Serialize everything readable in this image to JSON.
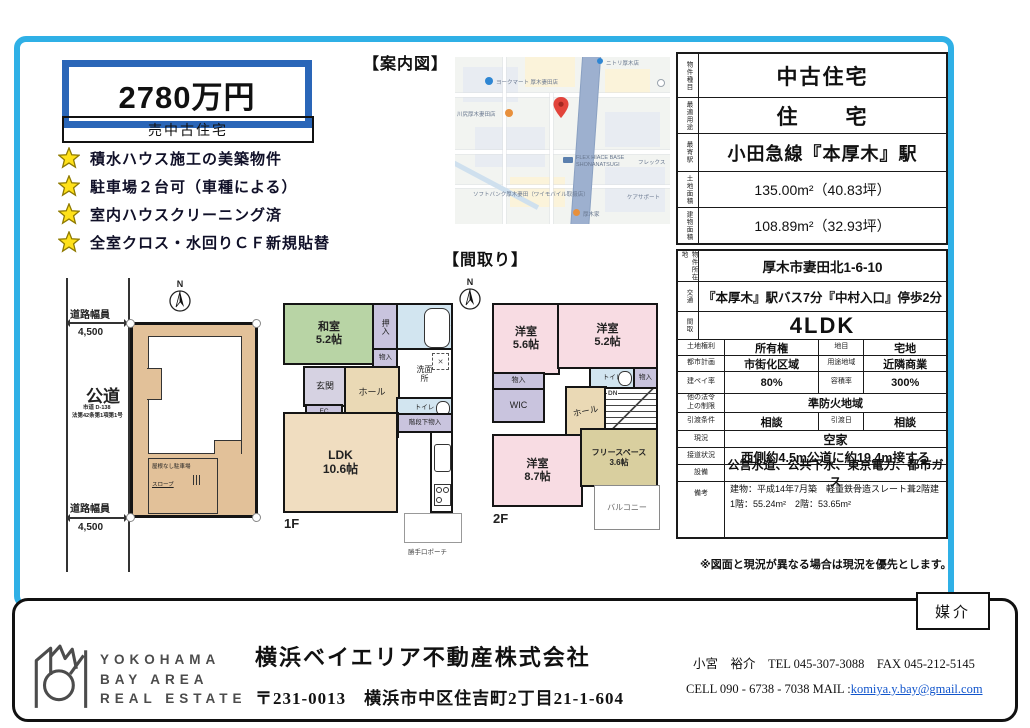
{
  "colors": {
    "frame_blue": "#2fb0e6",
    "price_border": "#2a66b8",
    "star_yellow": "#ffe11a",
    "map_pin_red": "#e2443b",
    "tatami_green": "#b8d4a5",
    "closet_lavender": "#c9c4de",
    "bath_blue": "#d2e5f0",
    "hall_beige": "#ead9b5",
    "ldk_beige": "#f0ddc0",
    "bedroom_pink": "#f8dce3",
    "free_khaki": "#d9cf9f",
    "lot_tan": "#e2c199",
    "link_blue": "#1155cc"
  },
  "price": {
    "amount": "2780万円",
    "label": "売中古住宅"
  },
  "features": [
    "積水ハウス施工の美築物件",
    "駐車場２台可（車種による）",
    "室内ハウスクリーニング済",
    "全室クロス・水回りＣＦ新規貼替"
  ],
  "sections": {
    "map_title": "【案内図】",
    "floorplan_title": "【間取り】"
  },
  "map": {
    "pois": [
      {
        "name": "ヨークマート 厚木妻田店"
      },
      {
        "name": "ニトリ厚木店"
      },
      {
        "name": "川尻厚木妻田店"
      },
      {
        "name": "FLEX HIACE BASE SHONANATSUGI"
      },
      {
        "name": "ソフトバンク厚木妻田（ワイモバイル取扱店）"
      },
      {
        "name": "ケアサポート"
      },
      {
        "name": "厚木家"
      },
      {
        "name": "フレックス"
      }
    ]
  },
  "site_plan": {
    "north": "N",
    "width_label": "道路幅員",
    "width_value": "4,500",
    "road_name": "公道",
    "road_sub1": "市道 D-138",
    "road_sub2": "法第42条第1項第1号",
    "parking_label": "屋根なし駐車場",
    "slope_label": "スロープ"
  },
  "floor1": {
    "name": "1F",
    "north": "N",
    "washitsu": "和室",
    "washitsu_size": "5.2帖",
    "oshiire": "押入",
    "bath": "浴室",
    "monoire": "物入",
    "senmen": "洗面所",
    "genkan": "玄関",
    "ec": "EC",
    "hall": "ホール",
    "toilet": "トイレ",
    "kaidan": "階段下物入",
    "up": "UP",
    "ldk": "LDK",
    "ldk_size": "10.6帖",
    "porch": "勝手口ポーチ"
  },
  "floor2": {
    "name": "2F",
    "room1": "洋室",
    "room1_size": "5.6帖",
    "room2": "洋室",
    "room2_size": "5.2帖",
    "monoire1": "物入",
    "monoire2": "物入",
    "toilet": "トイレ",
    "wic": "WIC",
    "hall": "ホール",
    "dn": "DN",
    "room3": "洋室",
    "room3_size": "8.7帖",
    "free": "フリースペース",
    "free_size": "3.6帖",
    "balcony": "バルコニー"
  },
  "table_a": [
    {
      "label": "物件種目",
      "value": "中古住宅"
    },
    {
      "label": "最適用途",
      "value": "住　　宅"
    },
    {
      "label": "最寄駅",
      "value": "小田急線『本厚木』駅"
    },
    {
      "label": "土地面積",
      "value": "135.00m²（40.83坪）"
    },
    {
      "label": "建物面積",
      "value": "108.89m²（32.93坪）"
    }
  ],
  "table_b": [
    {
      "label": "物件所在地",
      "value": "厚木市妻田北1-6-10"
    },
    {
      "label": "交通",
      "value": "『本厚木』駅バス7分『中村入口』停歩2分"
    },
    {
      "label": "間取",
      "value": "4LDK"
    },
    {
      "label": "土地権利",
      "value": "所有権",
      "label2": "地目",
      "value2": "宅地"
    },
    {
      "label": "都市計画",
      "value": "市街化区域",
      "label2": "用途地域",
      "value2": "近隣商業"
    },
    {
      "label": "建ペイ率",
      "value": "80%",
      "label2": "容積率",
      "value2": "300%"
    },
    {
      "label_l1": "他の法令",
      "label_l2": "上の制限",
      "value": "準防火地域"
    },
    {
      "label": "引渡条件",
      "value": "相談",
      "label2": "引渡日",
      "value2": "相談"
    },
    {
      "label": "現況",
      "value": "空家"
    },
    {
      "label": "接道状況",
      "value": "西側約4.5m公道に約19.4m接する"
    },
    {
      "label": "設備",
      "value": "公営水道、公共下水、東京電力、都市ガス"
    },
    {
      "label": "備考",
      "line1": "建物：平成14年7月築　軽量鉄骨造スレート葺2階建",
      "line2": "1階：55.24m²　2階：53.65m²"
    }
  ],
  "note": "※図面と現況が異なる場合は現況を優先とします。",
  "footer": {
    "badge": "媒介",
    "logo_line1": "YOKOHAMA",
    "logo_line2": "BAY AREA",
    "logo_line3": "REAL ESTATE",
    "company": "横浜ベイエリア不動産株式会社",
    "address": "〒231-0013　横浜市中区住吉町2丁目21-1-604",
    "agent": "小宮　裕介　TEL 045-307-3088　FAX 045-212-5145",
    "cell": "CELL 090 - 6738 - 7038 MAIL :",
    "mail": "komiya.y.bay@gmail.com"
  }
}
